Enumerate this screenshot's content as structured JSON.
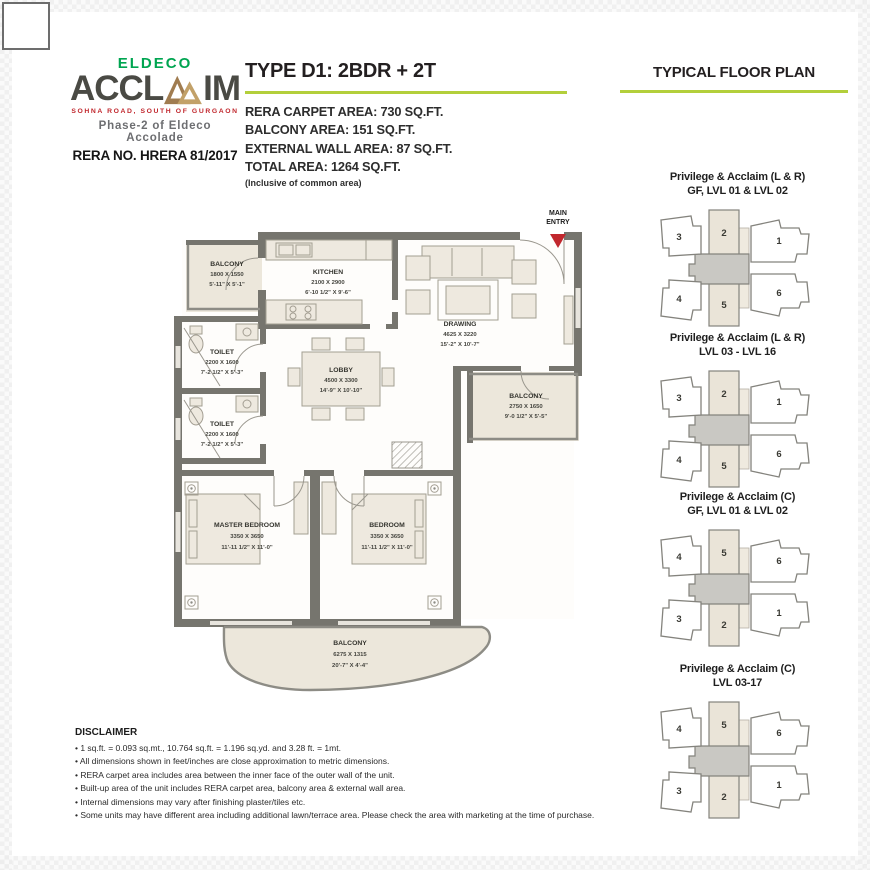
{
  "colors": {
    "brand-green": "#00a551",
    "accent-green": "#b3cf3b",
    "brand-red": "#c1272d",
    "wall": "#76756e",
    "beige": "#ece7db",
    "charcoal": "#4a4a44"
  },
  "logo": {
    "brand_top": "ELDECO",
    "brand_main_left": "ACCL",
    "brand_main_right": "IM",
    "tagline": "SOHNA ROAD, SOUTH OF GURGAON",
    "phase": "Phase-2 of Eldeco Accolade",
    "rera": "RERA NO. HRERA 81/2017"
  },
  "header": {
    "unit_type": "TYPE D1: 2BDR + 2T",
    "areas": [
      "RERA CARPET AREA: 730 SQ.FT.",
      "BALCONY AREA: 151 SQ.FT.",
      "EXTERNAL WALL AREA: 87 SQ.FT.",
      "TOTAL AREA: 1264  SQ.FT."
    ],
    "areas_note": "(Inclusive of common area)",
    "plan_title": "TYPICAL FLOOR PLAN"
  },
  "floor_plan": {
    "main_entry_1": "MAIN",
    "main_entry_2": "ENTRY",
    "rooms": [
      {
        "name": "BALCONY",
        "mm": "1800 X 1550",
        "ft": "5'-11\" X 5'-1\""
      },
      {
        "name": "KITCHEN",
        "mm": "2100 X 2900",
        "ft": "6'-10 1/2\" X 9'-6\""
      },
      {
        "name": "DRAWING",
        "mm": "4625 X 3220",
        "ft": "15'-2\" X 10'-7\""
      },
      {
        "name": "TOILET",
        "mm": "2200 X 1600",
        "ft": "7'-2 1/2\" X 5'-3\""
      },
      {
        "name": "LOBBY",
        "mm": "4500 X 3300",
        "ft": "14'-9\" X 10'-10\""
      },
      {
        "name": "TOILET",
        "mm": "2200 X 1600",
        "ft": "7'-2 1/2\" X 5'-3\""
      },
      {
        "name": "BALCONY",
        "mm": "2750 X 1650",
        "ft": "9'-0 1/2\" X 5'-5\""
      },
      {
        "name": "MASTER BEDROOM",
        "mm": "3350 X 3650",
        "ft": "11'-11 1/2\" X 11'-0\""
      },
      {
        "name": "BEDROOM",
        "mm": "3350 X 3650",
        "ft": "11'-11 1/2\" X 11'-0\""
      },
      {
        "name": "BALCONY",
        "mm": "6275 X 1315",
        "ft": "20'-7\" X 4'-4\""
      }
    ]
  },
  "key_plans": [
    {
      "title1": "Privilege & Acclaim (L & R)",
      "title2": "GF, LVL 01 & LVL 02",
      "units": {
        "tl": "3",
        "tc": "2",
        "tr": "1",
        "bl": "4",
        "bc": "5",
        "br": "6"
      }
    },
    {
      "title1": "Privilege & Acclaim (L & R)",
      "title2": "LVL 03 - LVL 16",
      "units": {
        "tl": "3",
        "tc": "2",
        "tr": "1",
        "bl": "4",
        "bc": "5",
        "br": "6"
      }
    },
    {
      "title1": "Privilege & Acclaim (C)",
      "title2": "GF, LVL 01 & LVL 02",
      "units": {
        "tl": "4",
        "tc": "5",
        "tr": "6",
        "bl": "3",
        "bc": "2",
        "br": "1"
      }
    },
    {
      "title1": "Privilege & Acclaim (C)",
      "title2": "LVL 03-17",
      "units": {
        "tl": "4",
        "tc": "5",
        "tr": "6",
        "bl": "3",
        "bc": "2",
        "br": "1"
      }
    }
  ],
  "disclaimer": {
    "title": "DISCLAIMER",
    "items": [
      "1 sq.ft. = 0.093 sq.mt., 10.764 sq.ft. = 1.196 sq.yd. and 3.28 ft. = 1mt.",
      "All dimensions shown in feet/inches are close approximation to metric dimensions.",
      "RERA carpet area includes area between the inner face of the outer wall of the unit.",
      "Built-up area of the unit includes RERA carpet area, balcony area & external wall area.",
      "Internal dimensions may vary after finishing plaster/tiles etc.",
      "Some units may have different area including additional lawn/terrace area. Please check the area with marketing at the time of purchase."
    ]
  }
}
